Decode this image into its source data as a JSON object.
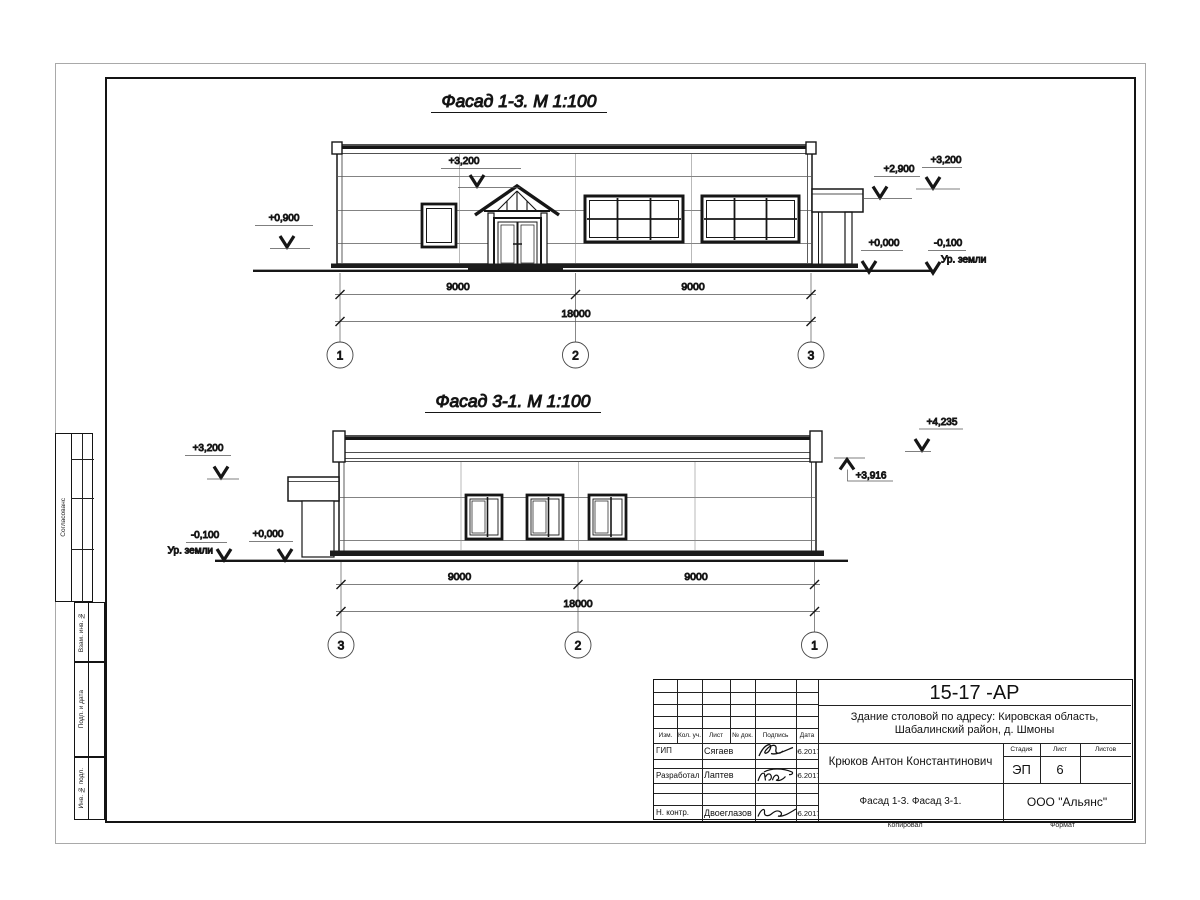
{
  "sheet": {
    "facade1": {
      "title": "Фасад 1-3.  М 1:100",
      "marks": {
        "roof_left": "+3,200",
        "window_sill": "+0,900",
        "canopy": "+2,900",
        "roof_right": "+3,200",
        "floor": "+0,000",
        "ground": "-0,100",
        "ground_label": "Ур. земли"
      },
      "dims": {
        "left": "9000",
        "right": "9000",
        "total": "18000"
      },
      "axes": [
        "1",
        "2",
        "3"
      ]
    },
    "facade2": {
      "title": "Фасад 3-1.  М 1:100",
      "marks": {
        "roof_left": "+3,200",
        "ground": "-0,100",
        "ground_label": "Ур. земли",
        "floor": "+0,000",
        "parapet_high": "+4,235",
        "parapet_low": "+3,916"
      },
      "dims": {
        "left": "9000",
        "right": "9000",
        "total": "18000"
      },
      "axes": [
        "3",
        "2",
        "1"
      ]
    },
    "side_strip": {
      "agreed": "Согласованс",
      "vzam": "Взам. инв. №",
      "podp": "Подп. и дата",
      "inv": "Инв. № подл."
    },
    "title_block": {
      "doc_number": "15-17 -АР",
      "project_line1": "Здание столовой по адресу: Кировская область,",
      "project_line2": "Шабалинский район, д. Шмоны",
      "chief": "Крюков Антон Константинович",
      "drawing_title": "Фасад 1-3. Фасад 3-1.",
      "company": "ООО \"Альянс\"",
      "stage_label": "Стадия",
      "sheet_label": "Лист",
      "sheets_label": "Листов",
      "stage": "ЭП",
      "sheet_number": "6",
      "header": {
        "izm": "Изм.",
        "kol": "Кол. уч.",
        "list": "Лист",
        "ndok": "№ док.",
        "sign": "Подпись",
        "date": "Дата"
      },
      "rows": [
        {
          "role": "ГИП",
          "name": "Сягаев",
          "date": "06.2017"
        },
        {
          "role": "Разработал",
          "name": "Лаптев",
          "date": "06.2017"
        },
        {
          "role": "Н. контр.",
          "name": "Двоеглазов",
          "date": "06.2017"
        }
      ],
      "copied": "Копировал",
      "format": "Формат"
    }
  }
}
